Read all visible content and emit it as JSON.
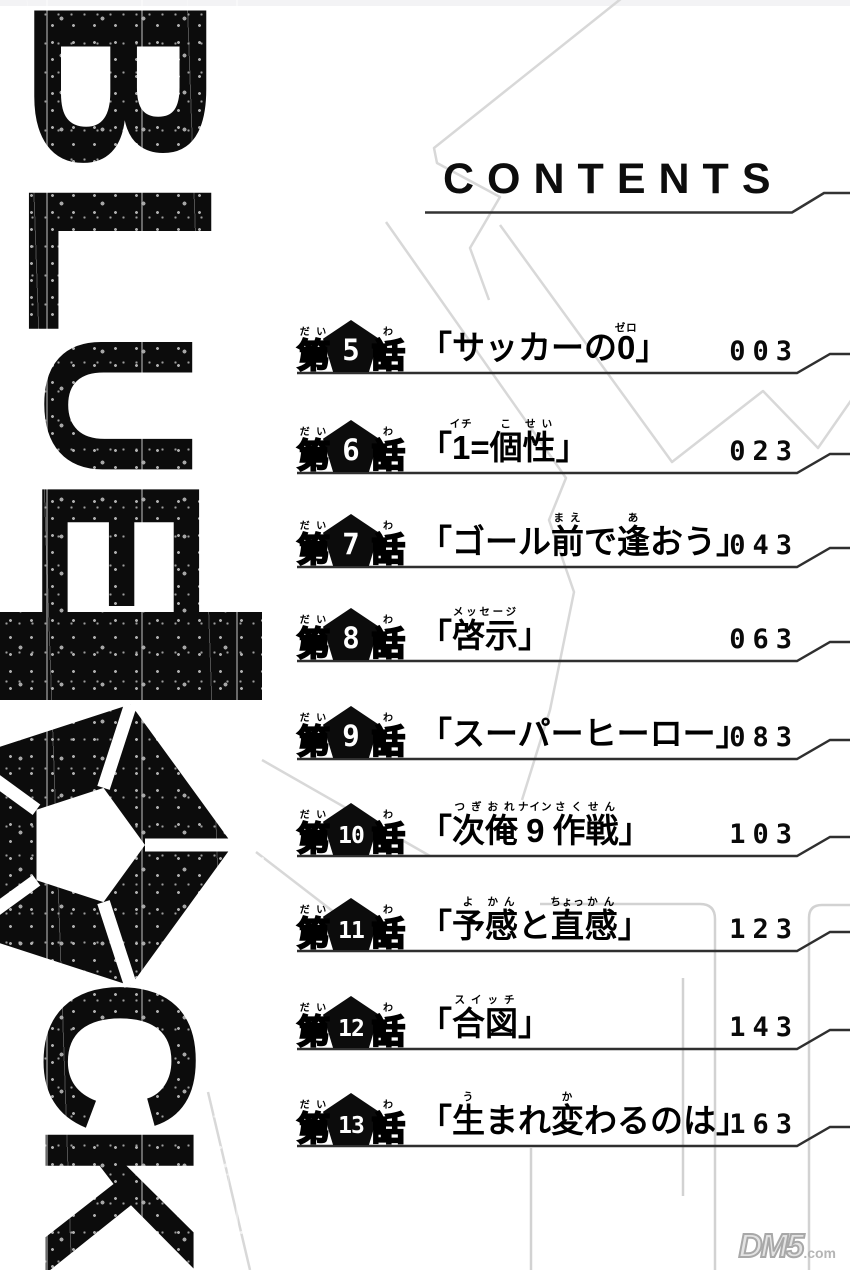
{
  "header": {
    "title": "CONTENTS"
  },
  "logo": {
    "text": "BLUELOCK"
  },
  "chapters": [
    {
      "prefix": "第",
      "prefix_ruby": "だい",
      "number": "5",
      "suffix": "話",
      "suffix_ruby": "わ",
      "page": "003",
      "title_segments": [
        {
          "t": "「サッカーの"
        },
        {
          "t": "0",
          "r": "ゼロ"
        },
        {
          "t": "」"
        }
      ]
    },
    {
      "prefix": "第",
      "prefix_ruby": "だい",
      "number": "6",
      "suffix": "話",
      "suffix_ruby": "わ",
      "page": "023",
      "title_segments": [
        {
          "t": "「"
        },
        {
          "t": "1",
          "r": "イチ"
        },
        {
          "t": "="
        },
        {
          "t": "個",
          "r": "こ"
        },
        {
          "t": "性",
          "r": "せい"
        },
        {
          "t": "」"
        }
      ]
    },
    {
      "prefix": "第",
      "prefix_ruby": "だい",
      "number": "7",
      "suffix": "話",
      "suffix_ruby": "わ",
      "page": "043",
      "title_segments": [
        {
          "t": "「ゴール"
        },
        {
          "t": "前",
          "r": "まえ"
        },
        {
          "t": "で"
        },
        {
          "t": "逢",
          "r": "あ"
        },
        {
          "t": "おう」"
        }
      ]
    },
    {
      "prefix": "第",
      "prefix_ruby": "だい",
      "number": "8",
      "suffix": "話",
      "suffix_ruby": "わ",
      "page": "063",
      "title_segments": [
        {
          "t": "「"
        },
        {
          "t": "啓示",
          "r": "メッセージ"
        },
        {
          "t": "」"
        }
      ]
    },
    {
      "prefix": "第",
      "prefix_ruby": "だい",
      "number": "9",
      "suffix": "話",
      "suffix_ruby": "わ",
      "page": "083",
      "title_segments": [
        {
          "t": "「スーパーヒーロー」"
        }
      ]
    },
    {
      "prefix": "第",
      "prefix_ruby": "だい",
      "number": "10",
      "suffix": "話",
      "suffix_ruby": "わ",
      "page": "103",
      "title_segments": [
        {
          "t": "「"
        },
        {
          "t": "次",
          "r": "つぎ"
        },
        {
          "t": "俺",
          "r": "おれ"
        },
        {
          "t": "9",
          "r": "ナイン"
        },
        {
          "t": "作",
          "r": "さく"
        },
        {
          "t": "戦",
          "r": "せん"
        },
        {
          "t": "」"
        }
      ]
    },
    {
      "prefix": "第",
      "prefix_ruby": "だい",
      "number": "11",
      "suffix": "話",
      "suffix_ruby": "わ",
      "page": "123",
      "title_segments": [
        {
          "t": "「"
        },
        {
          "t": "予",
          "r": "よ"
        },
        {
          "t": "感",
          "r": "かん"
        },
        {
          "t": "と"
        },
        {
          "t": "直",
          "r": "ちょっ"
        },
        {
          "t": "感",
          "r": "かん"
        },
        {
          "t": "」"
        }
      ]
    },
    {
      "prefix": "第",
      "prefix_ruby": "だい",
      "number": "12",
      "suffix": "話",
      "suffix_ruby": "わ",
      "page": "143",
      "title_segments": [
        {
          "t": "「"
        },
        {
          "t": "合図",
          "r": "スイッチ"
        },
        {
          "t": "」"
        }
      ]
    },
    {
      "prefix": "第",
      "prefix_ruby": "だい",
      "number": "13",
      "suffix": "話",
      "suffix_ruby": "わ",
      "page": "163",
      "title_segments": [
        {
          "t": "「"
        },
        {
          "t": "生",
          "r": "う"
        },
        {
          "t": "まれ"
        },
        {
          "t": "変",
          "r": "か"
        },
        {
          "t": "わるのは」"
        }
      ]
    }
  ],
  "watermark": {
    "brand": "DM5",
    "suffix": ".com"
  }
}
